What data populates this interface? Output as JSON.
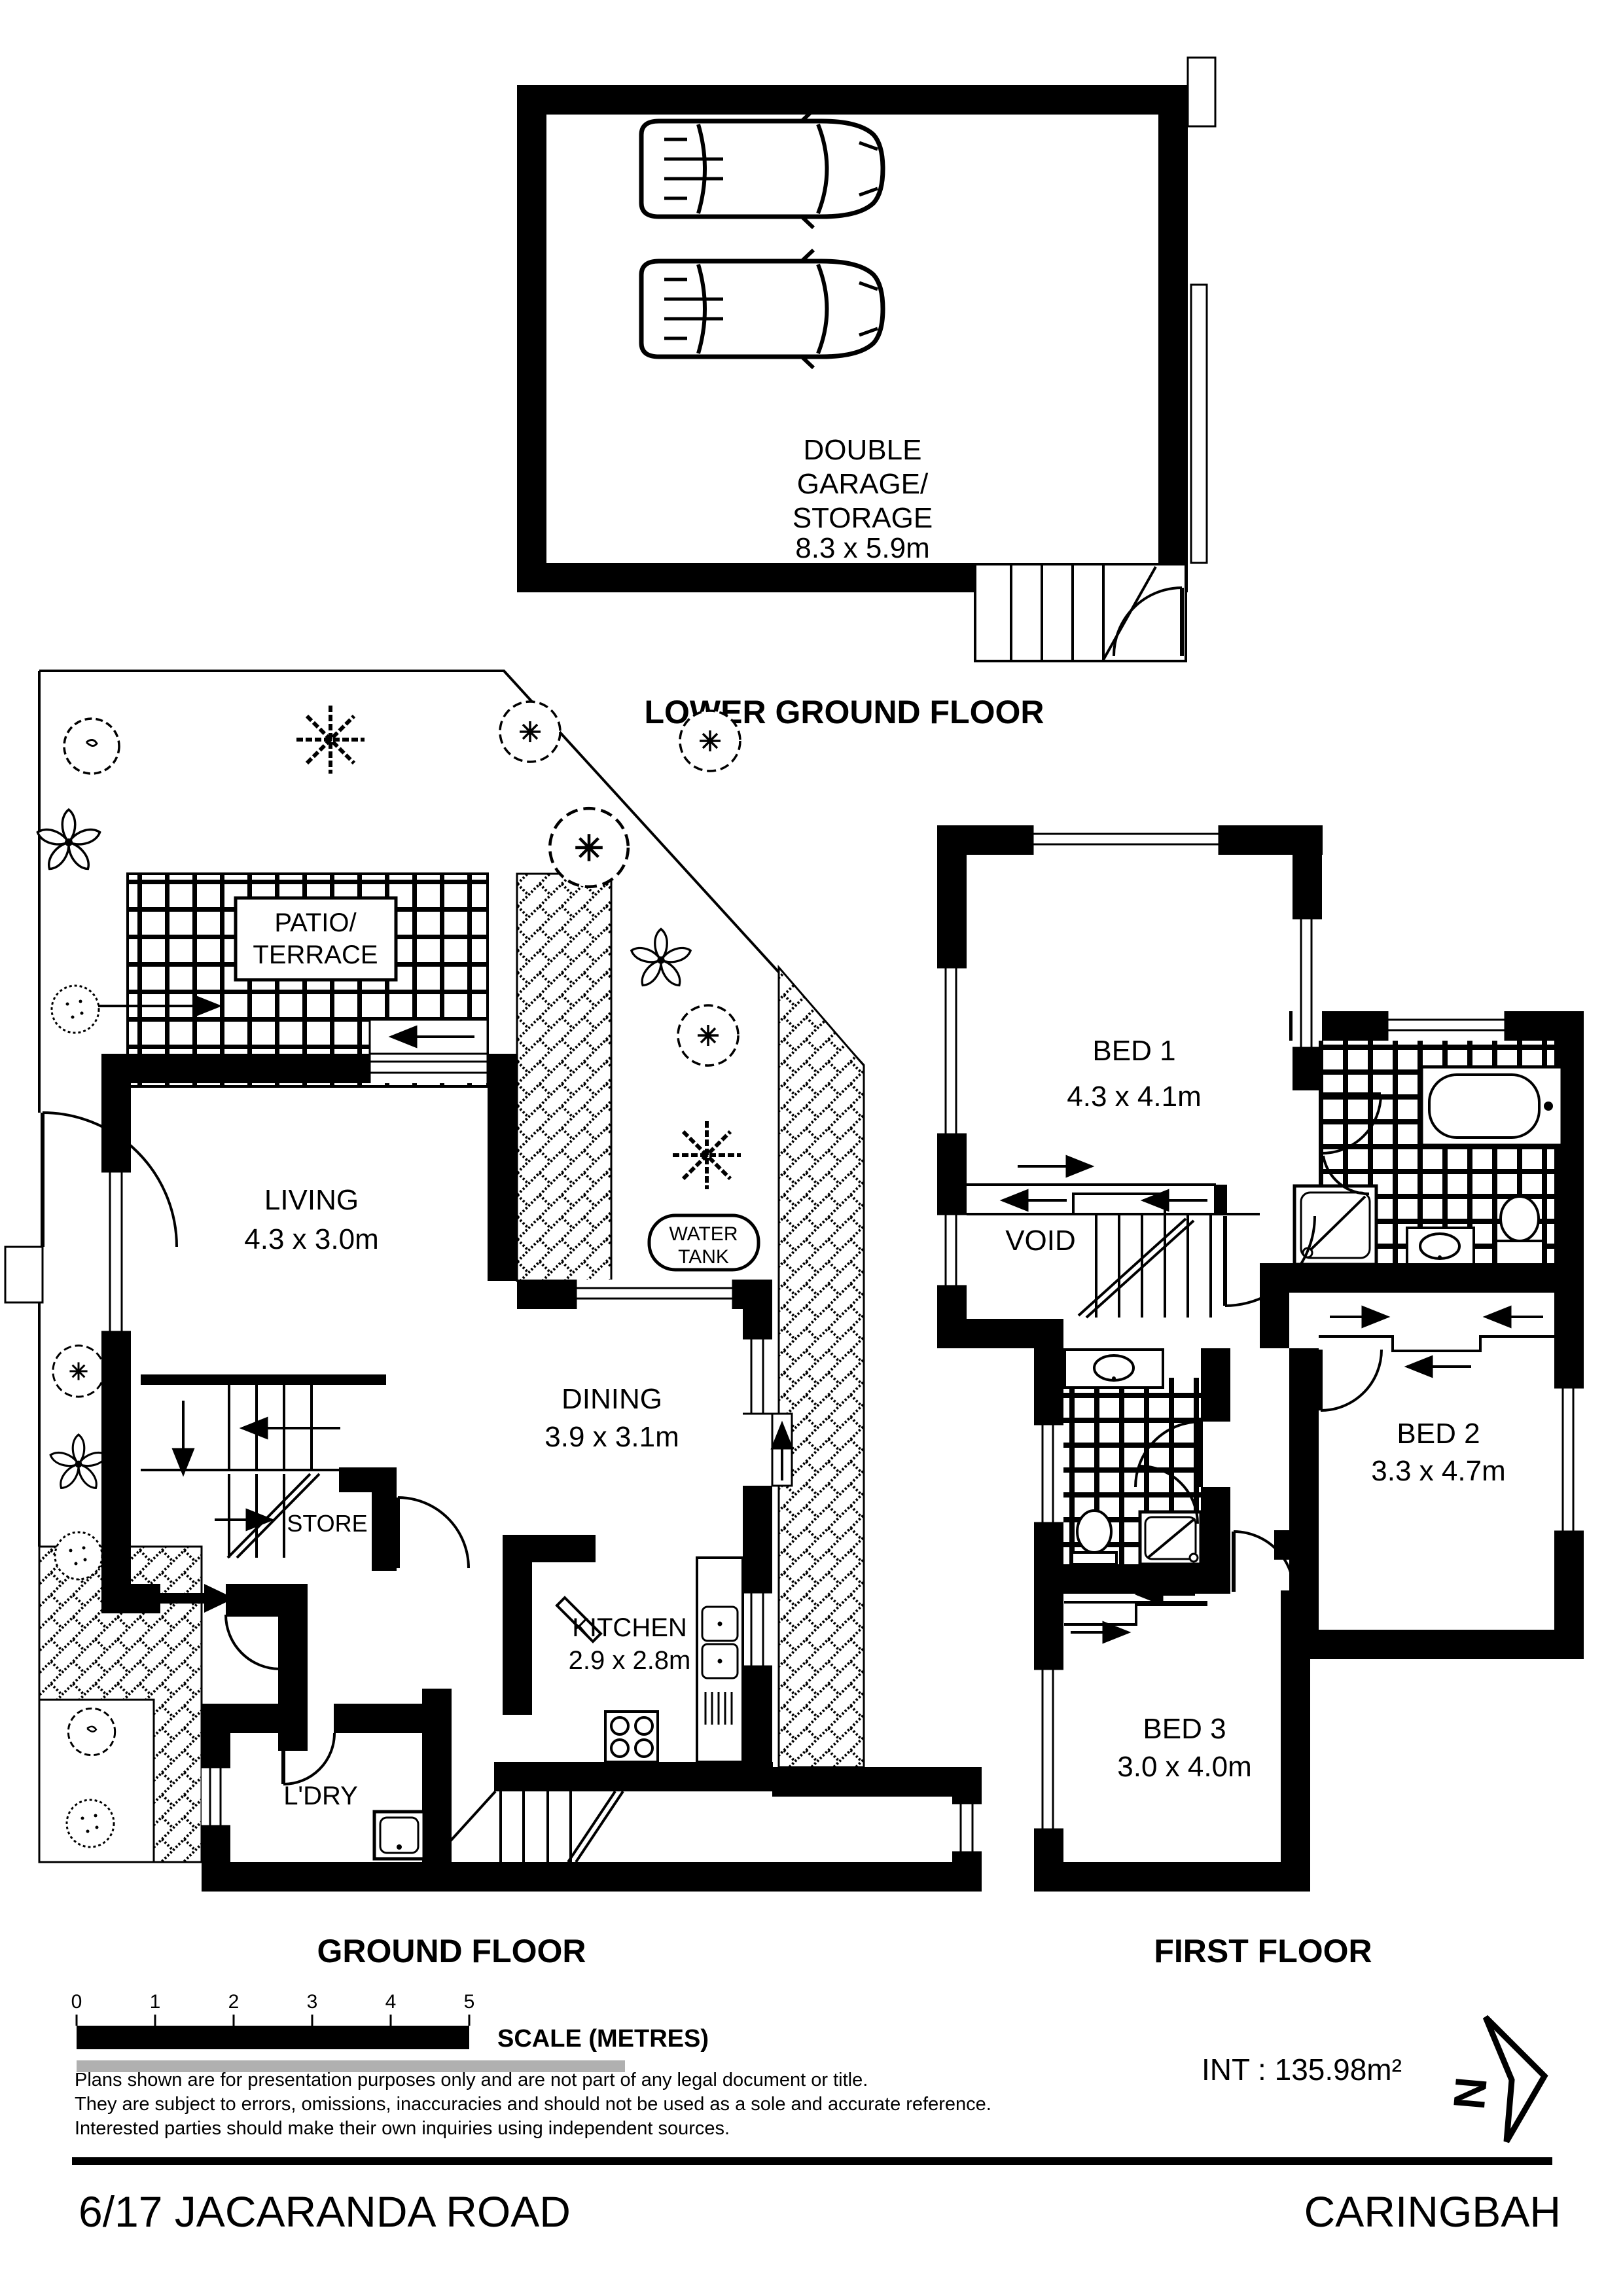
{
  "colors": {
    "ink": "#000000",
    "paper": "#ffffff",
    "gray_bar": "#b0b0b0"
  },
  "floors": {
    "lower_ground": {
      "title": "LOWER GROUND FLOOR",
      "garage": {
        "lines": [
          "DOUBLE",
          "GARAGE/",
          "STORAGE"
        ],
        "dims": "8.3 x 5.9m"
      }
    },
    "ground": {
      "title": "GROUND FLOOR",
      "patio": {
        "line1": "PATIO/",
        "line2": "TERRACE"
      },
      "living": {
        "name": "LIVING",
        "dims": "4.3 x 3.0m"
      },
      "dining": {
        "name": "DINING",
        "dims": "3.9 x 3.1m"
      },
      "kitchen": {
        "name": "KITCHEN",
        "dims": "2.9 x 2.8m"
      },
      "store": {
        "name": "STORE"
      },
      "laundry": {
        "name": "L'DRY"
      },
      "water_tank": {
        "line1": "WATER",
        "line2": "TANK"
      }
    },
    "first": {
      "title": "FIRST FLOOR",
      "bed1": {
        "name": "BED 1",
        "dims": "4.3 x 4.1m"
      },
      "bed2": {
        "name": "BED 2",
        "dims": "3.3 x 4.7m"
      },
      "bed3": {
        "name": "BED 3",
        "dims": "3.0 x 4.0m"
      },
      "void": {
        "name": "VOID"
      }
    }
  },
  "scale_bar": {
    "ticks": [
      "0",
      "1",
      "2",
      "3",
      "4",
      "5"
    ],
    "label": "SCALE (METRES)"
  },
  "disclaimer": {
    "line1": "Plans shown are for presentation purposes only and are not part of any legal document or title.",
    "line2": "They are subject to errors, omissions, inaccuracies and should not be used as a sole and accurate reference.",
    "line3": "Interested parties should make their own inquiries using independent sources."
  },
  "area": {
    "text": "INT : 135.98m²"
  },
  "north": {
    "letter": "N"
  },
  "footer": {
    "address": "6/17 JACARANDA ROAD",
    "suburb": "CARINGBAH"
  }
}
